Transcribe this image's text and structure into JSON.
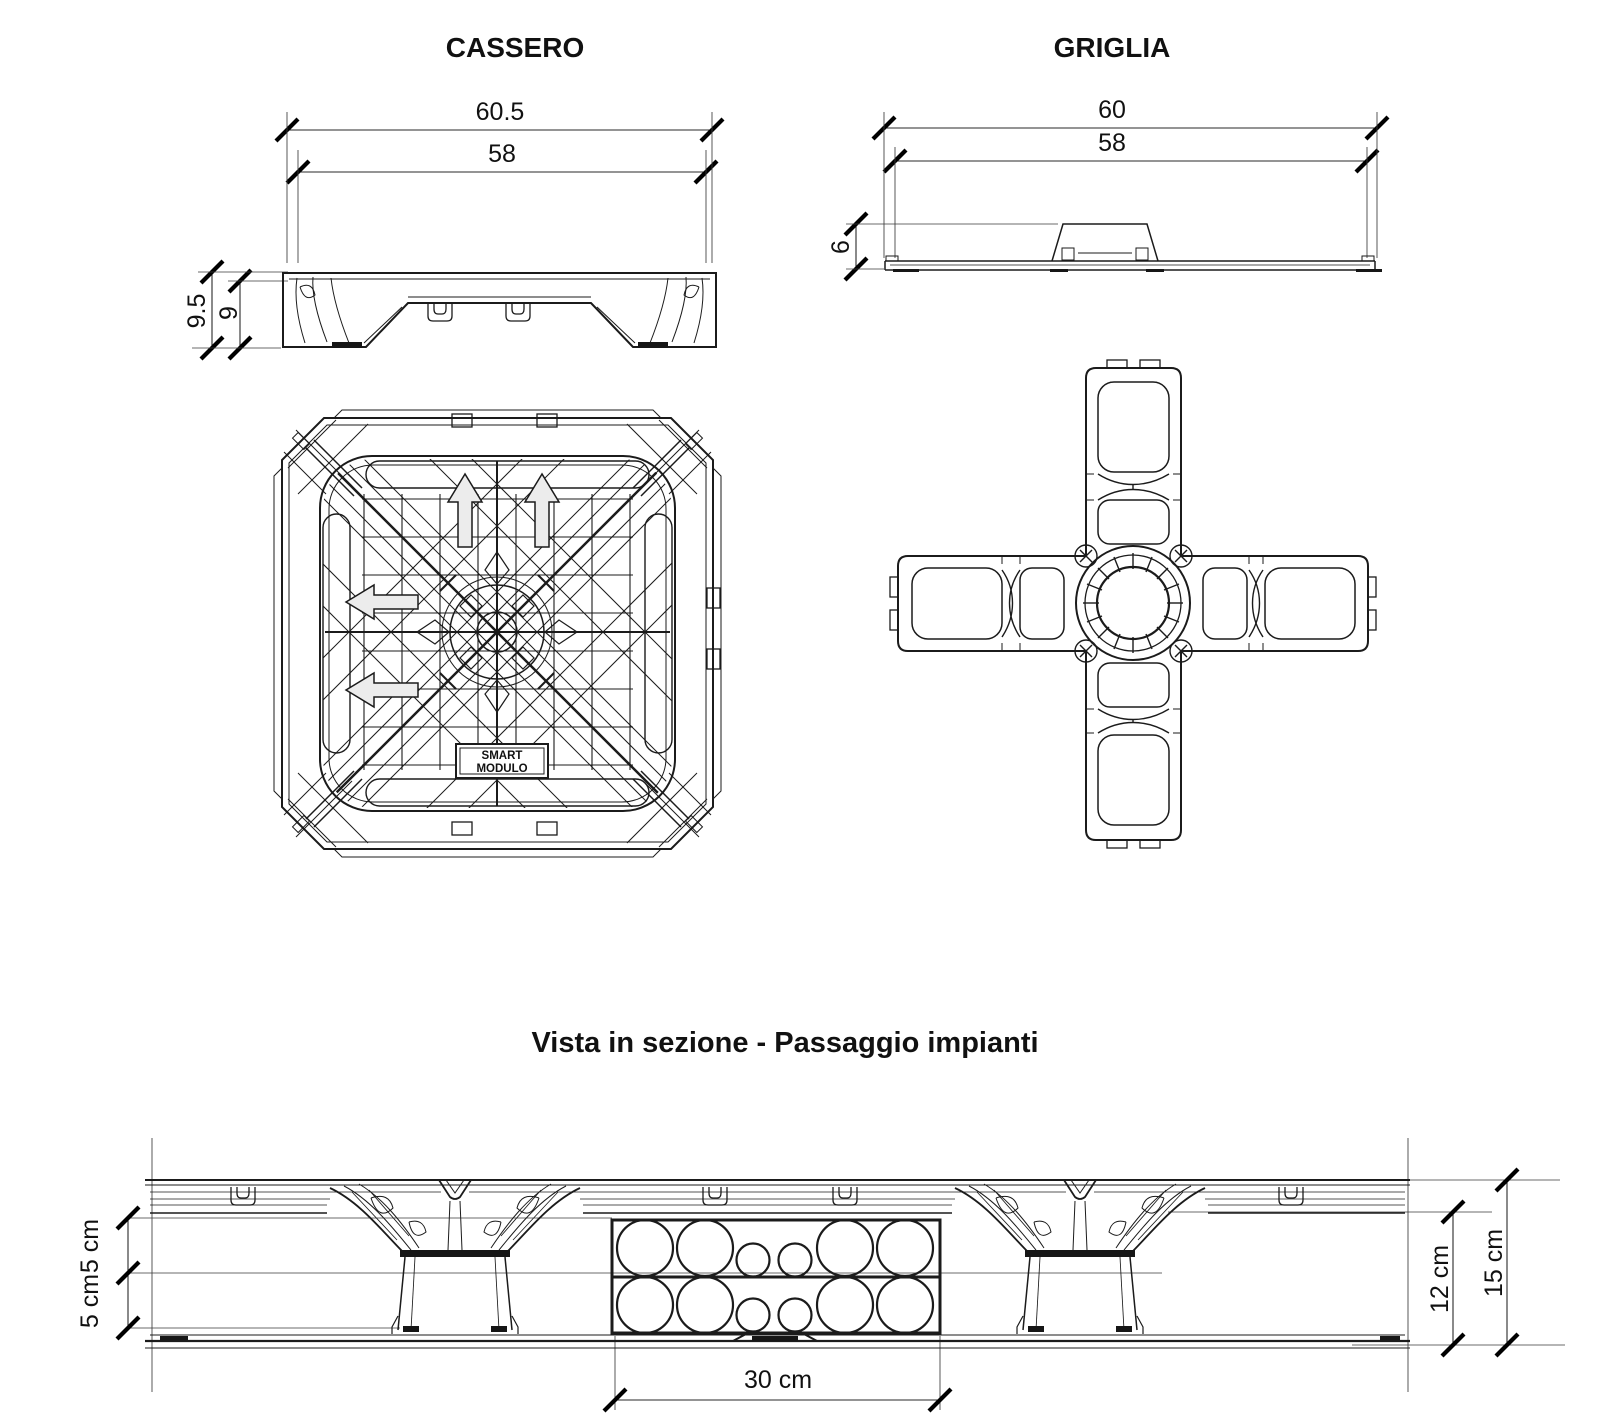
{
  "sheet": {
    "cassero": {
      "title": "CASSERO",
      "width_outer": "60.5",
      "width_inner": "58",
      "height_total": "9.5",
      "height_body": "9",
      "brand_line1": "SMART",
      "brand_line2": "MODULO"
    },
    "griglia": {
      "title": "GRIGLIA",
      "width_outer": "60",
      "width_inner": "58",
      "height": "6"
    },
    "section": {
      "title": "Vista in sezione - Passaggio impianti",
      "gap_upper": "5 cm",
      "gap_lower": "5 cm",
      "duct_width": "30 cm",
      "height_inner": "12 cm",
      "height_total": "15 cm"
    },
    "colors": {
      "line": "#1b1b1b",
      "background": "#ffffff",
      "arrow_fill": "#ececec"
    }
  }
}
